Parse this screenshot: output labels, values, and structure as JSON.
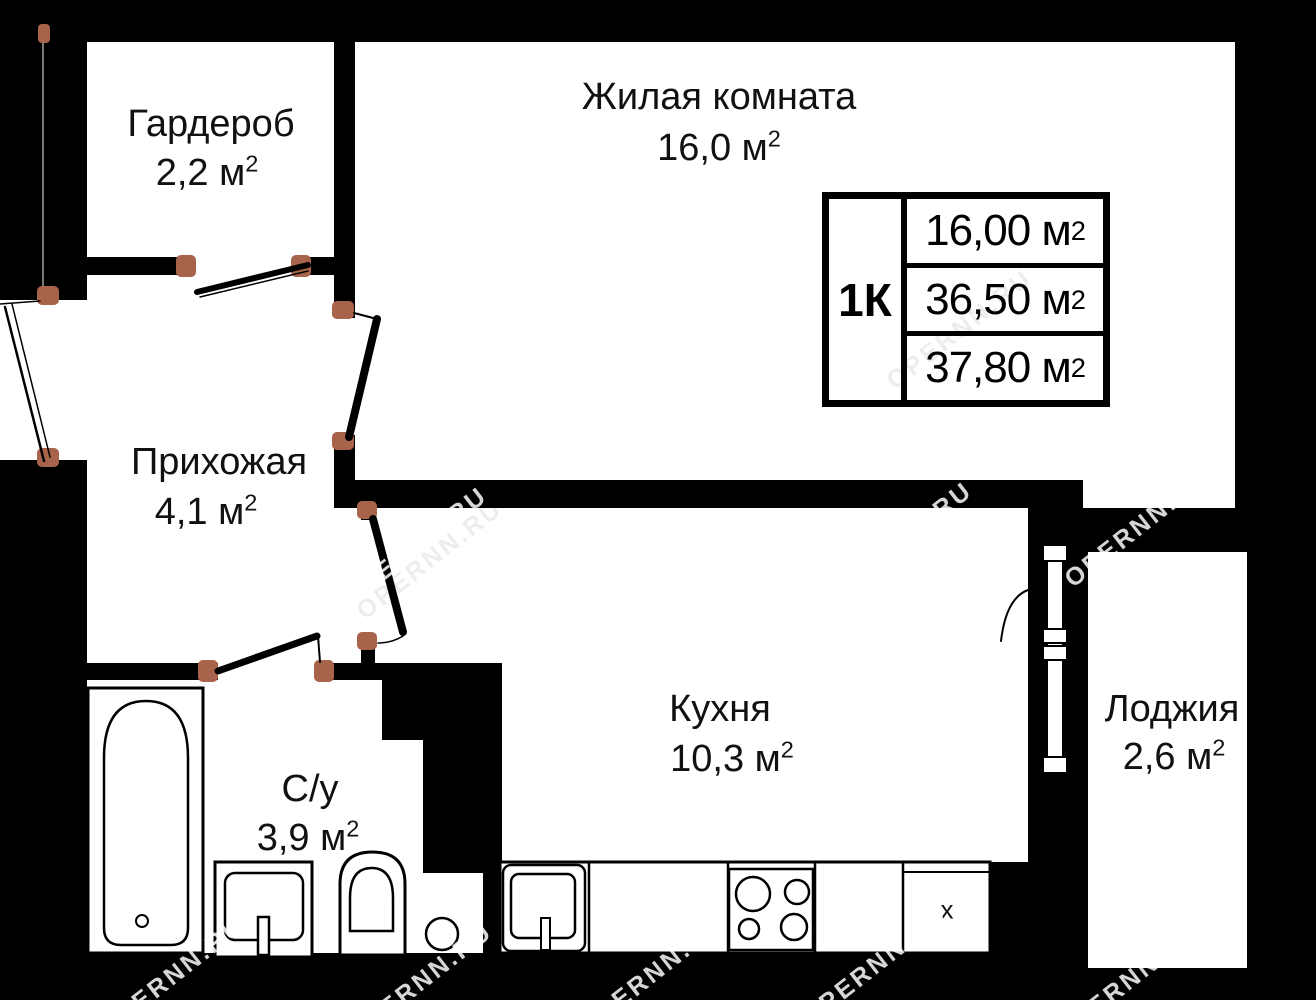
{
  "rooms": {
    "garderob": {
      "name": "Гардероб",
      "area": "2,2 м",
      "sup": "2"
    },
    "living": {
      "name": "Жилая комната",
      "area": "16,0 м",
      "sup": "2"
    },
    "hall": {
      "name": "Прихожая",
      "area": "4,1 м",
      "sup": "2"
    },
    "kitchen": {
      "name": "Кухня",
      "area": "10,3 м",
      "sup": "2"
    },
    "bath": {
      "name": "С/у",
      "area": "3,9 м",
      "sup": "2"
    },
    "loggia": {
      "name": "Лоджия",
      "area": "2,6 м",
      "sup": "2"
    }
  },
  "info_table": {
    "apartment_type": "1К",
    "rows": [
      {
        "value": "16,00 м",
        "sup": "2"
      },
      {
        "value": "36,50 м",
        "sup": "2"
      },
      {
        "value": "37,80 м",
        "sup": "2"
      }
    ]
  },
  "fixtures": {
    "vent_label": "х"
  },
  "watermark": {
    "text": "OPERNN.RU"
  },
  "colors": {
    "background": "#000000",
    "floor": "#ffffff",
    "wall": "#000000",
    "door_jamb": "#a8644a",
    "watermark_light": "#e2e2e2"
  }
}
